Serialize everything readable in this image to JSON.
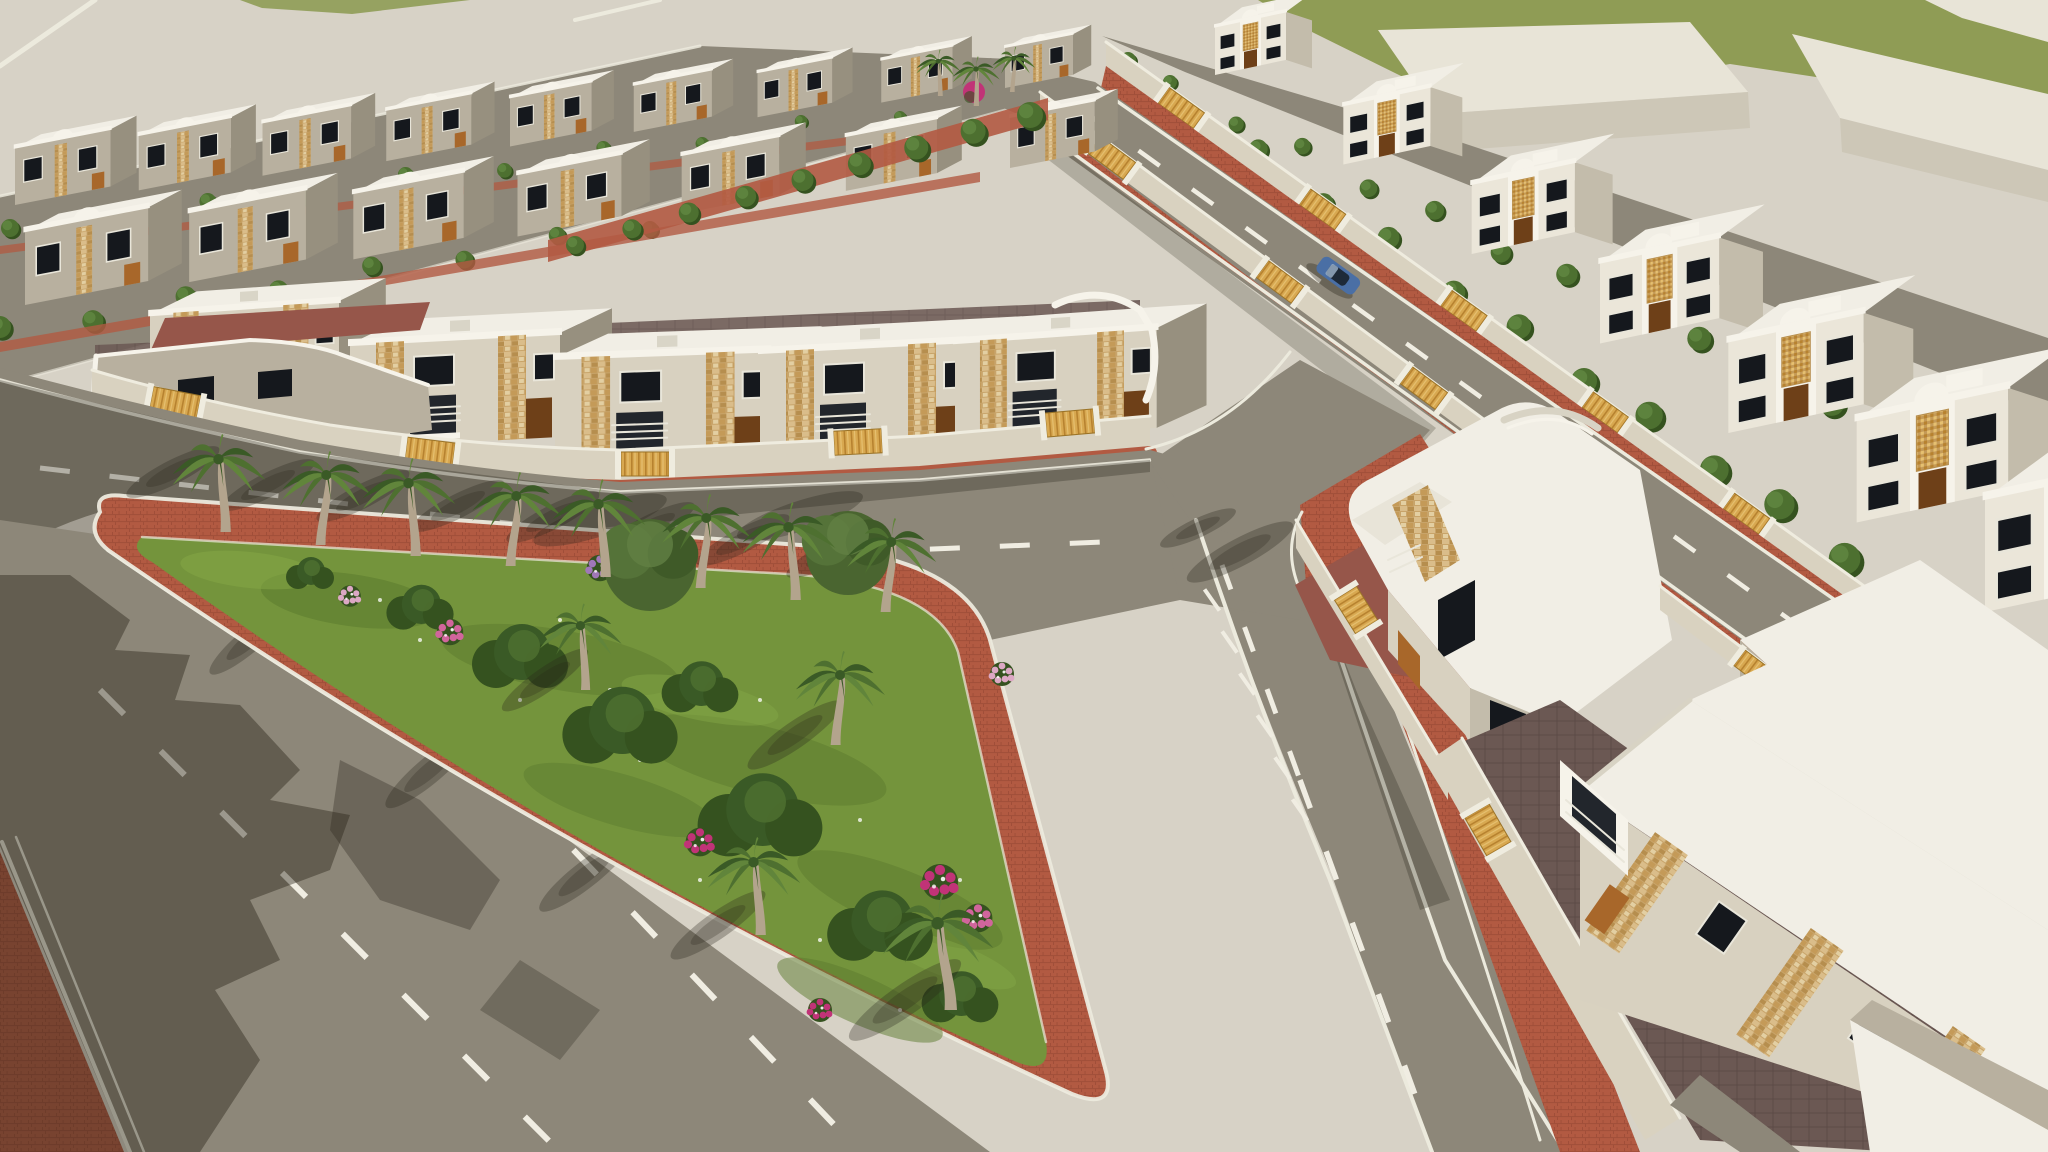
{
  "scene": {
    "type": "3d-architectural-rendering",
    "view": "aerial-perspective",
    "description": "Sunlit aerial 3D rendering of a beige residential villa compound: receding rows of two-storey white villas with stone-clad accent columns and golden gates, tree-lined internal streets, a triangular park island planted with palm trees, shrubs and pink bougainvillea, bounded by asphalt roads with white lane markings and red-brick sidewalks; a green field and plain neighbouring blocks border the development at the top.",
    "inventory": {
      "villa_rows": 5,
      "villas_middle_row": 5,
      "villas_right_row": 7,
      "villas_back_rows": 16,
      "park_palm_trees": 12,
      "street_palm_trees": 3,
      "hedge_trees": 46,
      "flower_clusters": 9,
      "broadleaf_trees": 2,
      "cars": 1,
      "roads": 4,
      "golden_gates": 18
    }
  },
  "palette": {
    "pale": "#d7d2c6",
    "road": "#8d8779",
    "marking": "#f0ede2",
    "curb": "#eceadd",
    "brick": "#b25a42",
    "brickDark": "#9e4d38",
    "field": "#8f9c55",
    "blockTop": "#e8e4d7",
    "blockSide": "#cdc7b7",
    "roof": "#f1eee5",
    "trim": "#f6f3ea",
    "faceLight": "#ebe6d9",
    "faceMid": "#d8d1c0",
    "faceTaupe": "#b8b09f",
    "sideDark": "#97907f",
    "sideLight": "#c3bcab",
    "window": "#15181d",
    "winFrame": "#e9e6da",
    "stone": "#c8a46a",
    "stoneLight": "#dabd8a",
    "stoneDark": "#b68e4e",
    "stonePale": "#e3cfa2",
    "stoneMid": "#c49a58",
    "gold": "#d8a850",
    "goldDark": "#b7822f",
    "goldLight": "#e6c070",
    "door": "#a8672a",
    "doorDark": "#6e4018",
    "hedgeDark": "#35521f",
    "hedge": "#4d7030",
    "hedgeLight": "#5f8540",
    "olive": "#4a6530",
    "palmDark": "#3a5a26",
    "palm": "#4e7030",
    "palmLight": "#61853b",
    "trunk": "#b3a48d",
    "lawn": "#74943c",
    "lawnDark": "#5b7a2e",
    "lawnLight": "#86a846",
    "flowerMagenta": "#c13377",
    "flowerPink": "#d1659c",
    "flowerPurple": "#a077b8",
    "flowerPale": "#dca8c4",
    "tilePurple": "#6b5853",
    "tileRed": "#96564a",
    "wallCream": "#d9d2c0",
    "wallCap": "#efecdf",
    "carBody": "#4a6fa5",
    "carGlass": "#1e2a38",
    "shadow": "#292319"
  }
}
